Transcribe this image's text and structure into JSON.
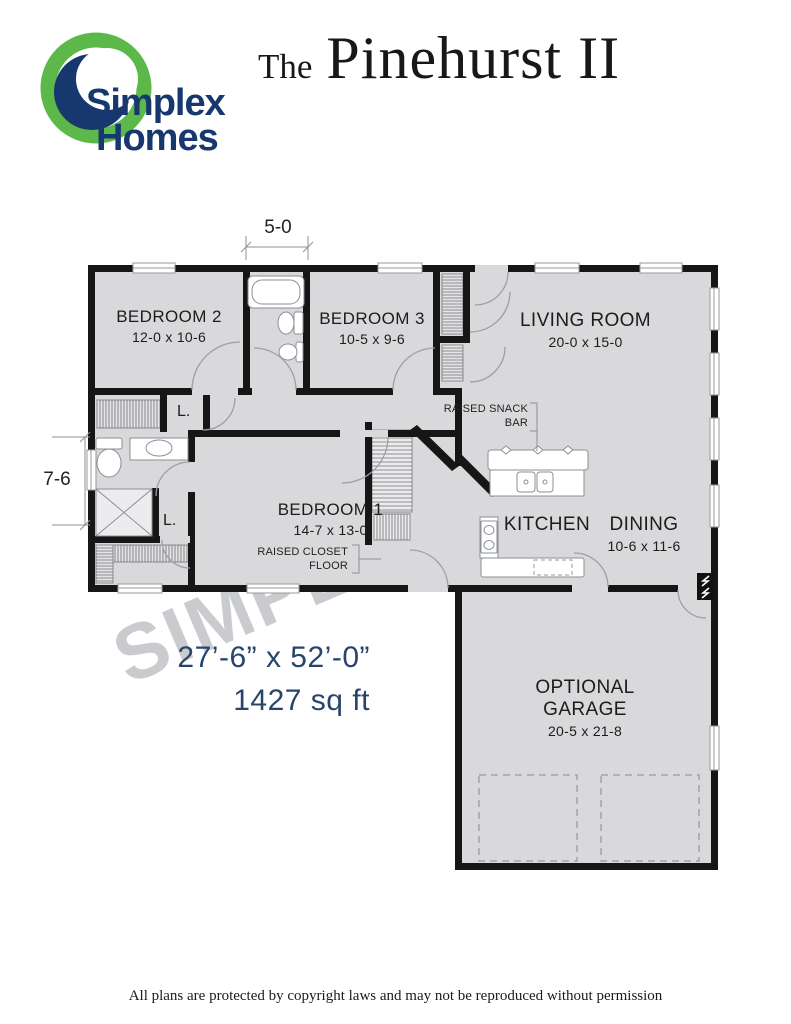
{
  "header": {
    "brand_top": "Simplex",
    "brand_bottom": "Homes",
    "title_the": "The",
    "title_name": "Pinehurst II"
  },
  "plan": {
    "rooms": [
      {
        "name": "BEDROOM 2",
        "dims": "12-0 x 10-6"
      },
      {
        "name": "BEDROOM 3",
        "dims": "10-5 x 9-6"
      },
      {
        "name": "LIVING ROOM",
        "dims": "20-0 x 15-0"
      },
      {
        "name": "BEDROOM 1",
        "dims": "14-7 x 13-0"
      },
      {
        "name": "KITCHEN"
      },
      {
        "name": "DINING",
        "dims": "10-6 x 11-6"
      },
      {
        "name": "OPTIONAL",
        "name2": "GARAGE",
        "dims": "20-5 x 21-8"
      }
    ],
    "notes": {
      "snack1": "RAISED SNACK",
      "snack2": "BAR",
      "closet1": "RAISED CLOSET",
      "closet2": "FLOOR",
      "linen": "L."
    },
    "dimensions": {
      "top": "5-0",
      "left": "7-6",
      "overall": "27’-6” x 52’-0”",
      "area": "1427 sq ft"
    },
    "watermark": "SIMPLEX"
  },
  "footer": {
    "text": "All plans are protected by copyright laws and may not be reproduced without permission"
  },
  "colors": {
    "brand_green": "#5cb849",
    "brand_navy": "#16386e",
    "dim_blue": "#27456b",
    "floor_gray": "#d9d9db",
    "wall_black": "#161616"
  }
}
